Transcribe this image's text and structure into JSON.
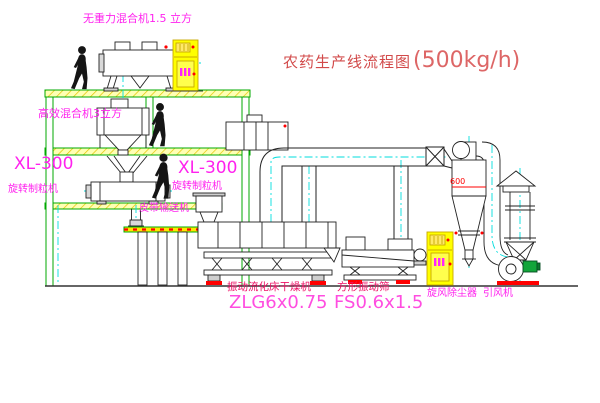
{
  "title": {
    "cn": "农药生产线流程图",
    "capacity": "(500kg/h)"
  },
  "labels": {
    "mixer_top": "无重力混合机1.5 立方",
    "mixer_mid": "高效混合机3立方",
    "granulator_left_model": "XL-300",
    "granulator_left_name": "旋转制粒机",
    "granulator_right_model": "XL-300",
    "granulator_right_name": "旋转制粒机",
    "belt_conveyor": "皮带输送机",
    "dryer_name": "振动流化床干燥机",
    "dryer_model": "ZLG6x0.75",
    "screen_name": "方形振动筛",
    "screen_model": "FS0.6x1.5",
    "cyclone_name": "旋风除尘器",
    "fan_name": "引风机",
    "cyclone_dim": "600"
  },
  "colors": {
    "label_magenta": "#ff22ee",
    "model_magenta": "#ff4de0",
    "name_red": "#ee1166",
    "title_red": "#d24a4a",
    "dimension_red": "#ff0000",
    "structure_green": "#00a800",
    "centerline_cyan": "#00dddd",
    "cabinet_yellow": "#ffff00"
  }
}
